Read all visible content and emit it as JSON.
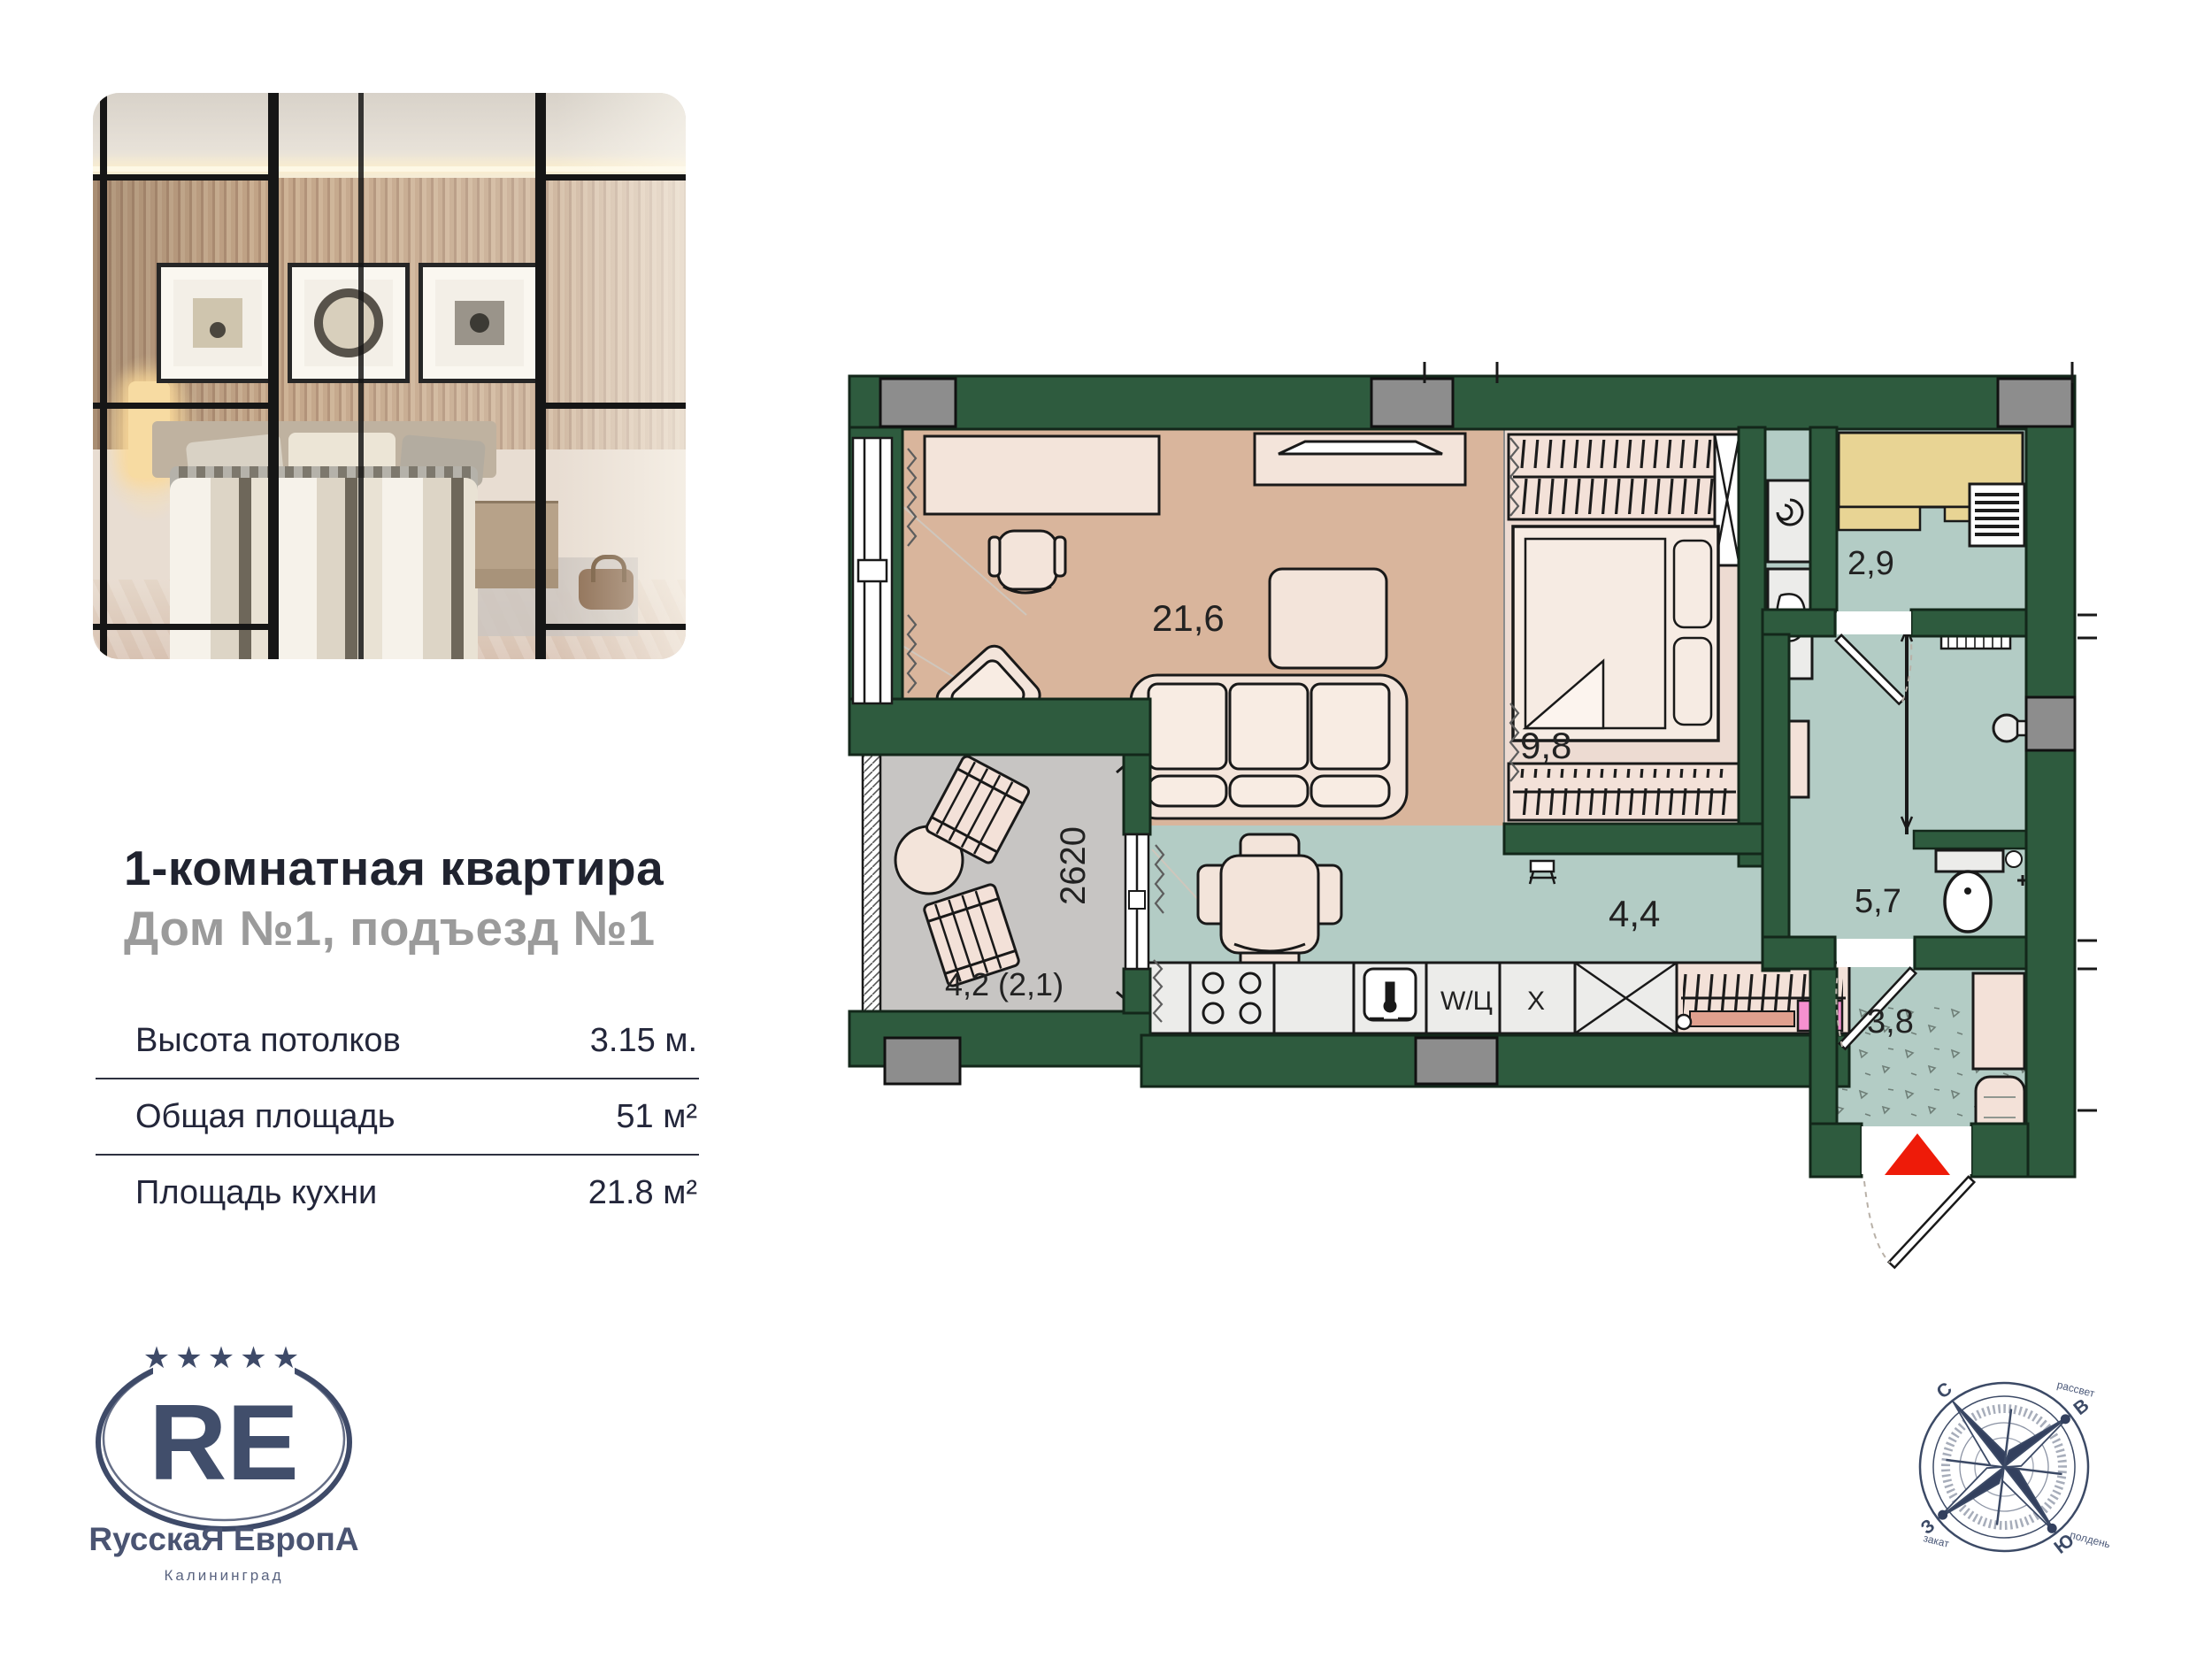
{
  "listing": {
    "title": "1-комнатная квартира",
    "subtitle": "Дом №1, подъезд №1"
  },
  "specs": {
    "rows": [
      {
        "label": "Высота потолков",
        "value": "3.15 м."
      },
      {
        "label": "Общая площадь",
        "value": "51 м²"
      },
      {
        "label": "Площадь кухни",
        "value": "21.8 м²"
      }
    ]
  },
  "logo": {
    "stars": "★★★★★",
    "monogram": "RE",
    "brand": "RусскаЯ ЕвропА",
    "city": "Калининград"
  },
  "floorplan": {
    "rooms": [
      {
        "id": "living",
        "area": "21,6"
      },
      {
        "id": "bedroom",
        "area": "9,8"
      },
      {
        "id": "storage",
        "area": "2,9"
      },
      {
        "id": "bathroom",
        "area": "5,7"
      },
      {
        "id": "hall",
        "area": "4,4"
      },
      {
        "id": "entry",
        "area": "3,8"
      },
      {
        "id": "balcony",
        "area": "4,2 (2,1)"
      }
    ],
    "balcony_dimension": "2620",
    "appliances": {
      "dishwasher": "W/Ц",
      "fridge": "Х"
    }
  },
  "compass": {
    "north": "С",
    "east": "В",
    "south": "Ю",
    "west": "З",
    "sunrise": "рассвет",
    "noon": "полдень",
    "sunset": "закат"
  },
  "colors": {
    "wall_green": "#2e5b3e",
    "floor_living": "#d9b59c",
    "floor_bedroom": "#eddbd2",
    "floor_wet": "#b3ccc5",
    "floor_balcony": "#c7c5c3",
    "accent_red": "#ee1b09",
    "brand_navy": "#3e4a68"
  }
}
